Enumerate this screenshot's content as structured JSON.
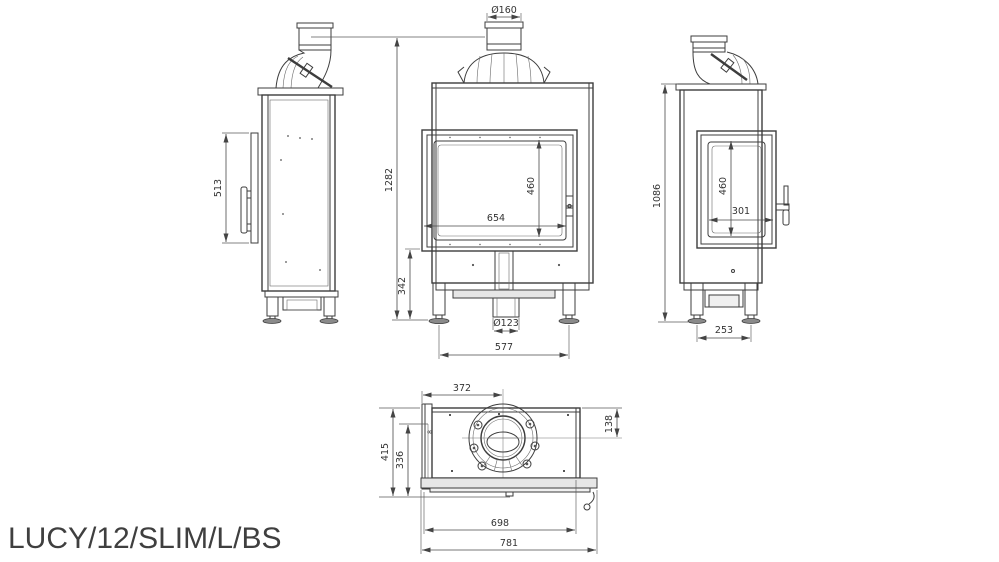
{
  "title": "LUCY/12/SLIM/L/BS",
  "drawing": {
    "left_view": {
      "door_height": "513"
    },
    "front_view": {
      "flue_diameter": "Ø160",
      "total_height": "1282",
      "glass_width": "654",
      "glass_height": "460",
      "base_height": "342",
      "air_inlet_diameter": "Ø123",
      "feet_spacing": "577"
    },
    "right_view": {
      "total_height": "1086",
      "glass_height": "460",
      "glass_width": "301",
      "feet_spacing": "253"
    },
    "top_view": {
      "flue_center_from_left": "372",
      "flue_center_from_back": "138",
      "depth_total": "415",
      "depth_inner": "336",
      "glass_thickness": "8",
      "width_inner": "698",
      "width_total": "781"
    }
  }
}
